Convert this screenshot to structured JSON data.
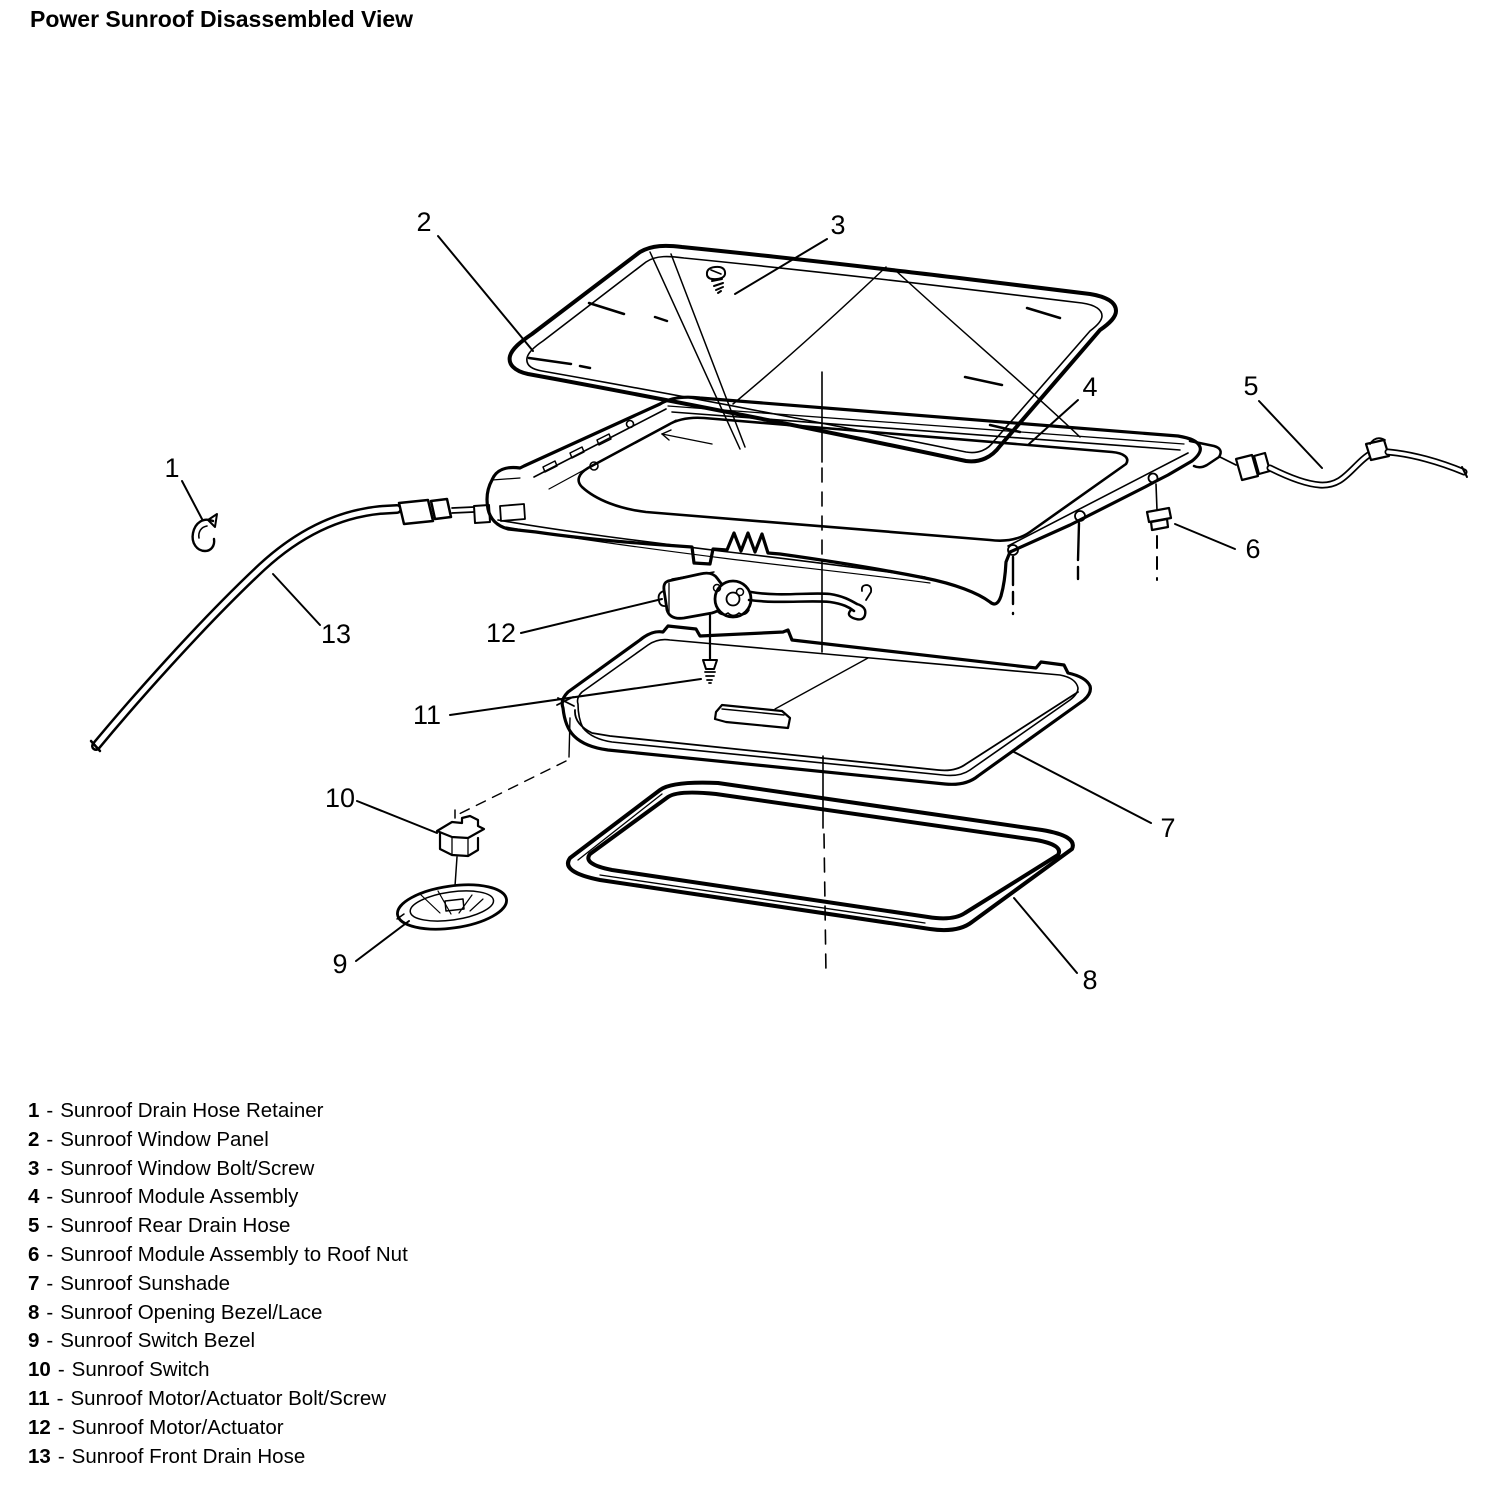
{
  "title": "Power Sunroof Disassembled View",
  "colors": {
    "ink": "#000000",
    "paper": "#ffffff"
  },
  "legend": {
    "items": [
      {
        "number": "1",
        "sep": "-",
        "label": "Sunroof Drain Hose Retainer"
      },
      {
        "number": "2",
        "sep": "-",
        "label": "Sunroof Window Panel"
      },
      {
        "number": "3",
        "sep": "-",
        "label": "Sunroof Window Bolt/Screw"
      },
      {
        "number": "4",
        "sep": "-",
        "label": "Sunroof Module Assembly"
      },
      {
        "number": "5",
        "sep": "-",
        "label": "Sunroof Rear Drain Hose"
      },
      {
        "number": "6",
        "sep": "-",
        "label": "Sunroof Module Assembly to Roof Nut"
      },
      {
        "number": "7",
        "sep": "-",
        "label": "Sunroof Sunshade"
      },
      {
        "number": "8",
        "sep": "-",
        "label": "Sunroof Opening Bezel/Lace"
      },
      {
        "number": "9",
        "sep": "-",
        "label": "Sunroof Switch Bezel"
      },
      {
        "number": "10",
        "sep": "-",
        "label": "Sunroof Switch"
      },
      {
        "number": "11",
        "sep": "-",
        "label": "Sunroof Motor/Actuator Bolt/Screw"
      },
      {
        "number": "12",
        "sep": "-",
        "label": "Sunroof Motor/Actuator"
      },
      {
        "number": "13",
        "sep": "-",
        "label": "Sunroof Front Drain Hose"
      }
    ]
  }
}
